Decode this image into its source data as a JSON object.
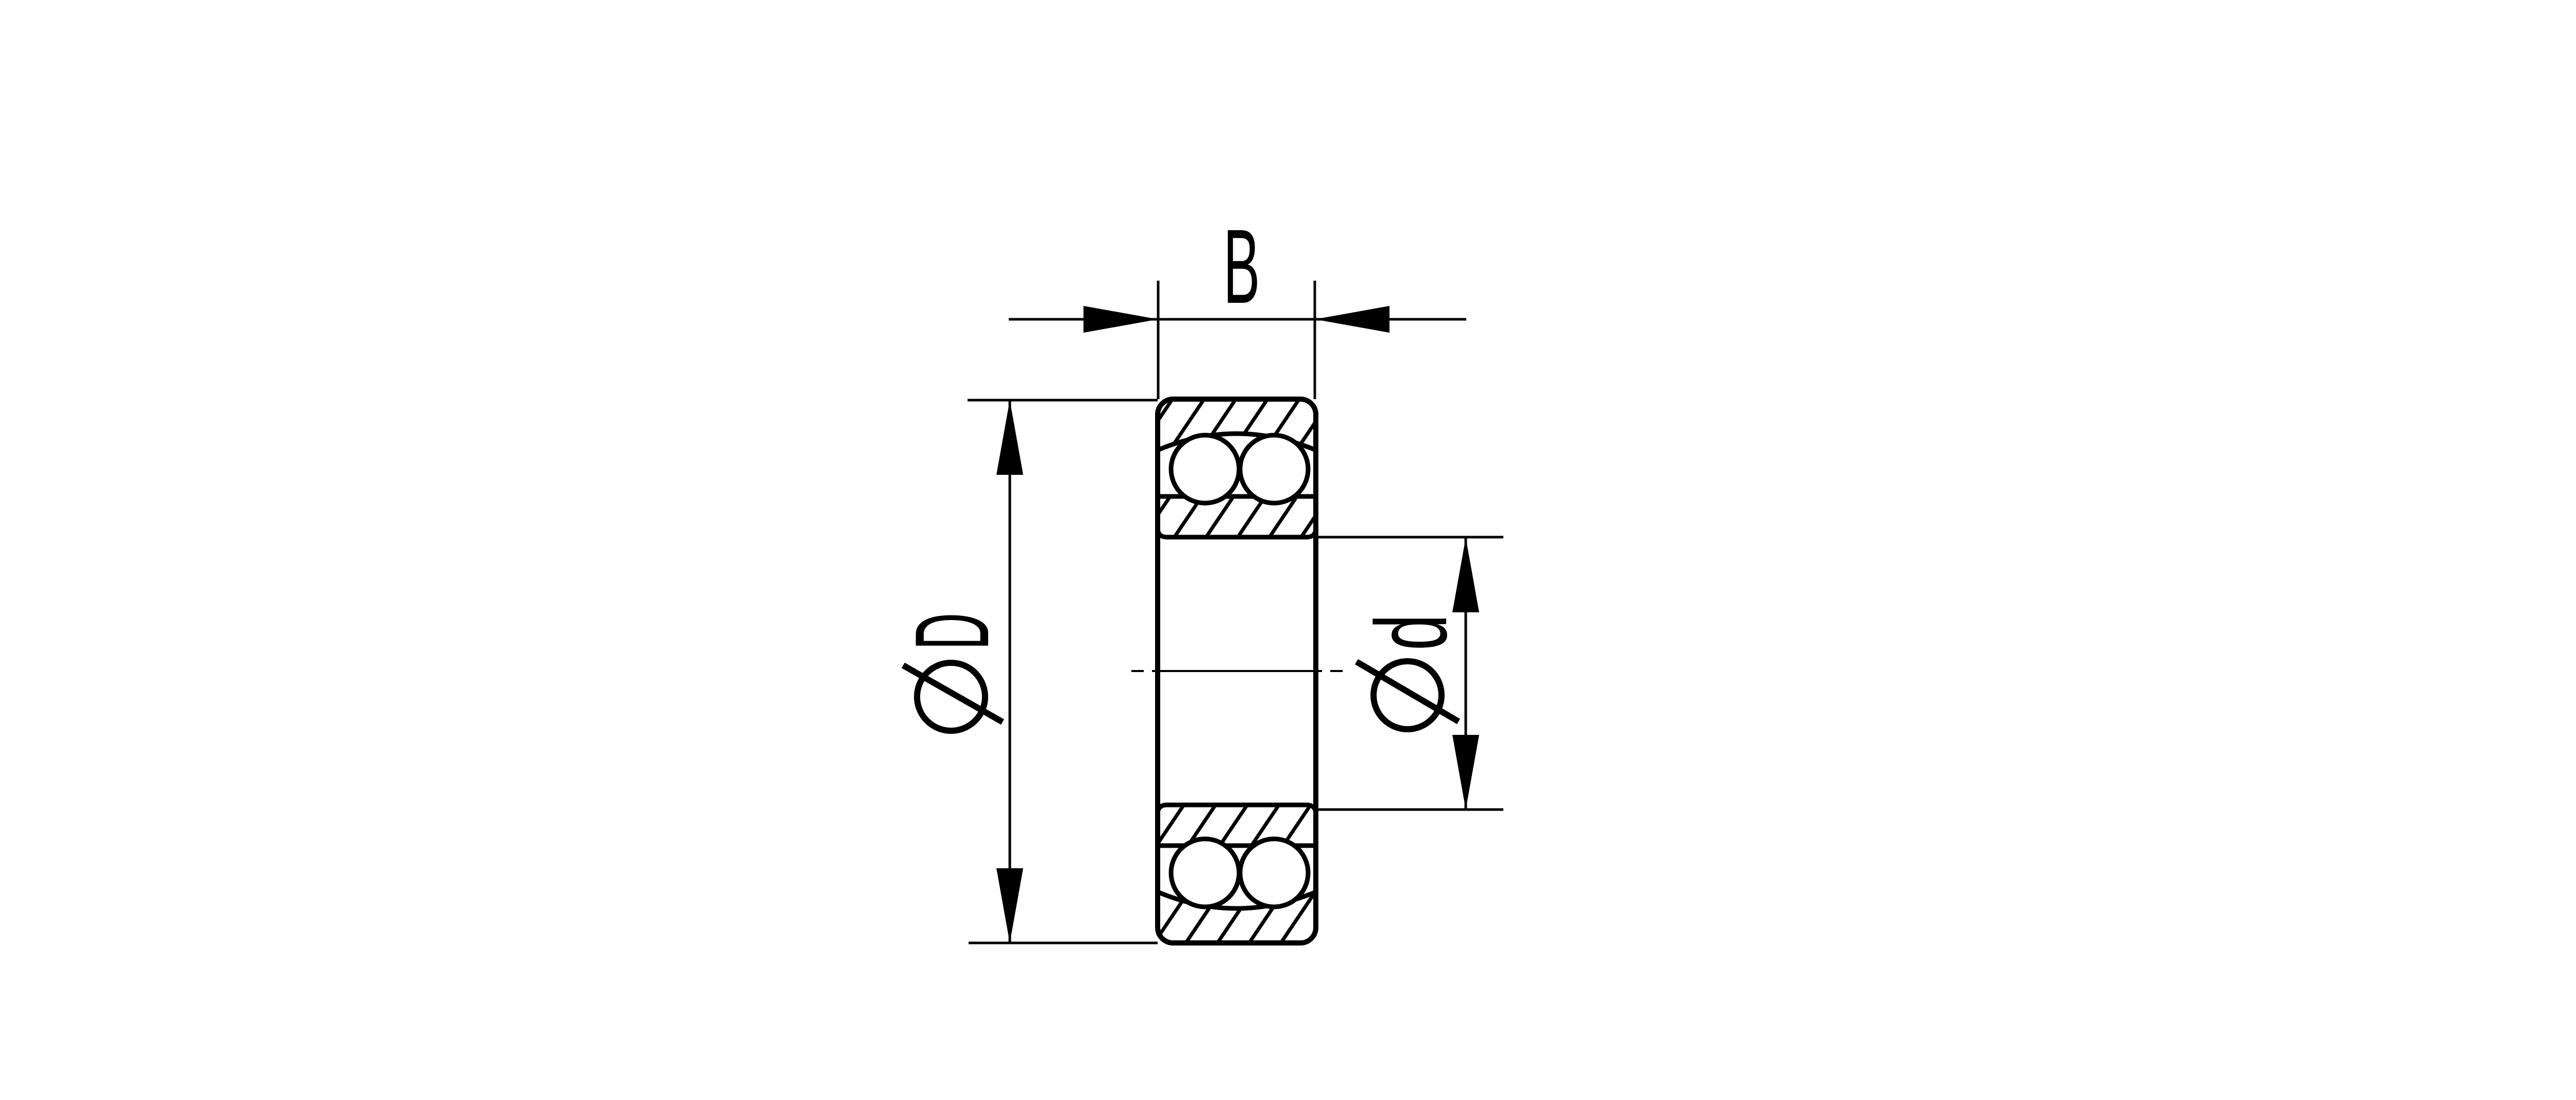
{
  "page": {
    "background_color": "#ffffff",
    "line_color": "#000000"
  },
  "drawing": {
    "kind": "double-row self-aligning ball bearing cross-section",
    "dimensions": {
      "width": {
        "label": "B"
      },
      "outer_diameter": {
        "symbol": "Ø",
        "label": "D"
      },
      "bore_diameter": {
        "symbol": "Ø",
        "label": "d"
      }
    }
  }
}
